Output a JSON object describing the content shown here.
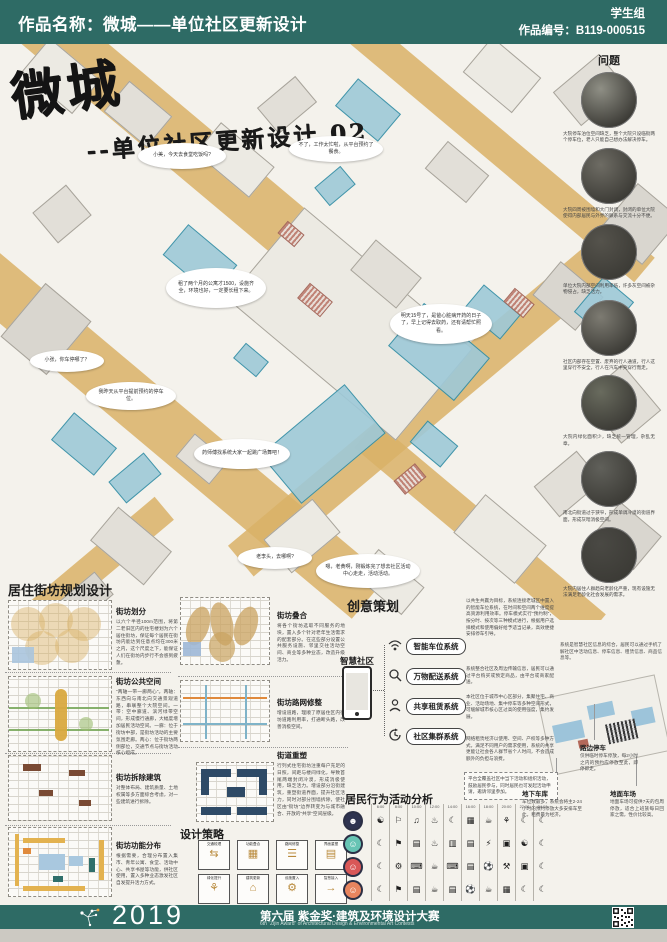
{
  "header": {
    "title": "作品名称：微城——单位社区更新设计",
    "group_label": "学生组",
    "number_label": "作品编号：B119-000515"
  },
  "hero": {
    "title": "微城",
    "subtitle": "--单位社区更新设计 02",
    "bubbles": [
      "小美，今天去食堂吃饭吗?",
      "不了，工作太忙啦，从平台预约了餐食。",
      "租了两个月的公寓才1500，设施齐全，环境也好，一定要长租下来。",
      "明天15号了，是爸心脏病开药的日子了，早上记得去取药，还有请帮忙照看。",
      "小张，你车停哪了？",
      "我昨天从平台提前预约的停车位。",
      "药师傅找系统大家一起跳广场舞吧！",
      "老李头，去哪啊?",
      "嗯，老黄啊，刚锻炼完了想去社区活动中心走走，活动活动。"
    ]
  },
  "problems": {
    "title": "问题",
    "items": [
      {
        "photo": "street-parking-photo",
        "caption": "大院停车泊位空间缺乏，整个大院只设临街两个停车位，老人只能自己想办法解决停车。"
      },
      {
        "photo": "walled-lane-photo",
        "caption": "大院四周被围墙和大门封闭，封闭的单位大院使得内部居民与外界的联系与交流十分不便。"
      },
      {
        "photo": "grey-corridor-photo",
        "caption": "单位大院内部空间利用率低，许多灰空间被杂物侵占，缺乏活力。"
      },
      {
        "photo": "cars-on-road-photo",
        "caption": "社区内部存在空置、废弃的行人通道，行人这里穿行不安全，行人在汽车中央穿行而走。"
      },
      {
        "photo": "messy-green-photo",
        "caption": "大院内绿化面积少，缺乏统一管理，杂乱无章。"
      },
      {
        "photo": "narrow-street-photo",
        "caption": "南北向街道过于狭窄，形成单调冷漠的街道界面，形成灰暗消极空间。"
      },
      {
        "photo": "elderly-crowd-photo",
        "caption": "大院内居住人群趋向老龄化严重，现有设施无法满足老龄化社会发展的需求。"
      }
    ]
  },
  "planning": {
    "title": "居住街坊规划设计",
    "blocks": [
      {
        "heading": "街坊划分",
        "body": "以六个半径100m范围，将第二老旧区内的住宅楼划为六个居住街坊，保证每个居民在街坊内能达到任意点均在300米之内，这个尺度之下，能保证人们在街坊内步行不会感到疲惫。"
      },
      {
        "heading": "街坊公共空间",
        "body": "“两轴一带一廊两心”。两轴：东西向与南北向交通景观道路，串联整个大院空间。一带：空中廊道、滨河绿带空间，形成慢行通廊，大幅度增加居民活动空间。一廊：位于街坊中部，是街坊活动的主要氛围走廊。两心：位于街坊两侧部位，交通节点与街坊活动核心组成。"
      },
      {
        "heading": "街坊拆除建筑",
        "body": "对整体布局、建筑质量、土地权属等多方面综合考虑，对一些建筑进行拆除。"
      },
      {
        "heading": "街坊功能分布",
        "body": "根据需要，合理分布置入集市、青年公寓、食堂、活动中心、共享书屋等功能，供社区使用，置入多种业态激发社区自发提升活力方式。"
      }
    ],
    "col2": [
      {
        "heading": "街坊叠合",
        "body": "将各个街坊选取不同服务的地块，置入多个针对老年生活需求的配套部分。在这些部分设置公共服务设施、邻里交往活动空间、商业等多种业态，改造升级活力。"
      },
      {
        "heading": "街坊路网修整",
        "body": "增设道路，理顺了原居住区内街坊道路利用率，打通断头路，改善消极空间。"
      },
      {
        "heading": "街道重塑",
        "body": "行列式住宅街坊注重每户充足的日照，间距与楼间绿化，导致首尾两端封闭冷漠，形成消极使用，缺乏活力。增设部分沿街建筑，重塑街道界面，提升社区活力，同时对部分围墙拆除，使社区由“街坊”边界转变为与城市融合、开放的“共享”空间层级。"
      }
    ],
    "strategy": {
      "title": "设计策略",
      "items": [
        {
          "label": "交通梳理",
          "glyph": "⇆"
        },
        {
          "label": "功能叠合",
          "glyph": "▦"
        },
        {
          "label": "路网修整",
          "glyph": "☰"
        },
        {
          "label": "界面重塑",
          "glyph": "▤"
        },
        {
          "label": "绿化提升",
          "glyph": "⚘"
        },
        {
          "label": "建筑更新",
          "glyph": "⌂"
        },
        {
          "label": "设施置入",
          "glyph": "⚙"
        },
        {
          "label": "智慧接入",
          "glyph": "→"
        }
      ]
    }
  },
  "creative": {
    "title": "创意策划",
    "smart_label": "智慧社区",
    "systems": [
      {
        "name": "智能车位系统",
        "icon": "wifi-icon",
        "desc": "以共生共赢为目标，系统连接老城区中置入的智能车位系统，在时间和空间两个维度提高资源利用效率。停车模式实行“预约制”，按分时、按次等三种模式进行，根据用户选择模式和使用偏好给予适当记录，高效便捷安排停车引导。"
      },
      {
        "name": "万物配送系统",
        "icon": "magnifier-icon",
        "desc": "系统整合社区及周边传输信息，居民可以通过平台购买或预定商品，由平台或商家配送。"
      },
      {
        "name": "共享租赁系统",
        "icon": "person-icon",
        "desc": "本社区位于城市中心区部分，集聚住宅、商业、活动场地、集中停车等多种空间形式，可缓解城市核心区过高的使用强度，集约发展。"
      },
      {
        "name": "社区集群系统",
        "icon": "clock-icon",
        "desc": "网络租赁经济以使用、空间、产权等多种方式，满足不同用户的需求使用，系统的共享更能让社会各人群节省个人时间，不会造成额外的负担与浪费。"
      }
    ],
    "right_note": "系统是智慧社区信息的综合，居民可以通过手机了解社区中活动信息、停车信息、租赁信息、商品信息等。",
    "activity_note": "平台全覆盖社区中当下活动和组织活动，鼓励居民参与，同时居民也可发起活动申请，邀请邻里参加。",
    "callouts": [
      {
        "title": "路边停车",
        "body": "仅供临时停车停放，每2小时之内的预约应停放至此，即停即走。"
      },
      {
        "title": "地下车库",
        "body": "车位数最多，系统会将主2-24小时的预约停放大多安排车至此，租费最为经济。"
      },
      {
        "title": "地面车场",
        "body": "地面车场可提供7天的包周停放，适合上班族每日回家之需，性价比较高。"
      }
    ]
  },
  "activity": {
    "title": "居民行为活动分析",
    "times": [
      "6:00",
      "8:00",
      "10:00",
      "12:00",
      "14:00",
      "16:00",
      "18:00",
      "20:00",
      "22:00",
      "24:00"
    ],
    "rows": [
      {
        "avatar": "elderly-avatar",
        "color": "#2e3350",
        "icons": [
          "taichi",
          "stroll",
          "radio",
          "cook",
          "nap",
          "mahjong",
          "meal",
          "plants",
          "sleep",
          "sleep"
        ]
      },
      {
        "avatar": "woman-avatar",
        "color": "#67c4b4",
        "icons": [
          "sleep",
          "commute",
          "work-doc",
          "cook",
          "shopping",
          "work-doc",
          "scooter",
          "tv",
          "yoga",
          "sleep"
        ]
      },
      {
        "avatar": "man-avatar",
        "color": "#d95757",
        "icons": [
          "sleep",
          "drive",
          "computer",
          "meal",
          "computer",
          "meeting",
          "basketball",
          "gym",
          "tv",
          "sleep"
        ]
      },
      {
        "avatar": "child-avatar",
        "color": "#e8855f",
        "icons": [
          "sleep",
          "school",
          "reading",
          "meal",
          "reading",
          "soccer",
          "meal",
          "game",
          "sleep",
          "sleep"
        ]
      }
    ]
  },
  "icon_glyphs": {
    "sleep": "☾",
    "taichi": "☯",
    "stroll": "⚐",
    "radio": "♫",
    "cook": "♨",
    "nap": "☾",
    "mahjong": "▦",
    "meal": "☕",
    "plants": "⚘",
    "commute": "⚑",
    "work-doc": "▤",
    "shopping": "▥",
    "scooter": "⚡",
    "tv": "▣",
    "yoga": "☯",
    "drive": "⚙",
    "computer": "⌨",
    "meeting": "▤",
    "basketball": "⚽",
    "gym": "⚒",
    "school": "⚑",
    "reading": "▤",
    "soccer": "⚽",
    "game": "▦"
  },
  "footer": {
    "year": "2019",
    "title": "第六届 紫金奖·建筑及环境设计大赛",
    "subtitle": "6th \"Zijin Award\" of Architectural Design & Environmental Art Contests"
  },
  "colors": {
    "teal": "#2e6b65",
    "ochre": "#d9b267",
    "drawing_blue": "#9ec9d8",
    "drawing_blue_line": "#2f8ca3"
  }
}
